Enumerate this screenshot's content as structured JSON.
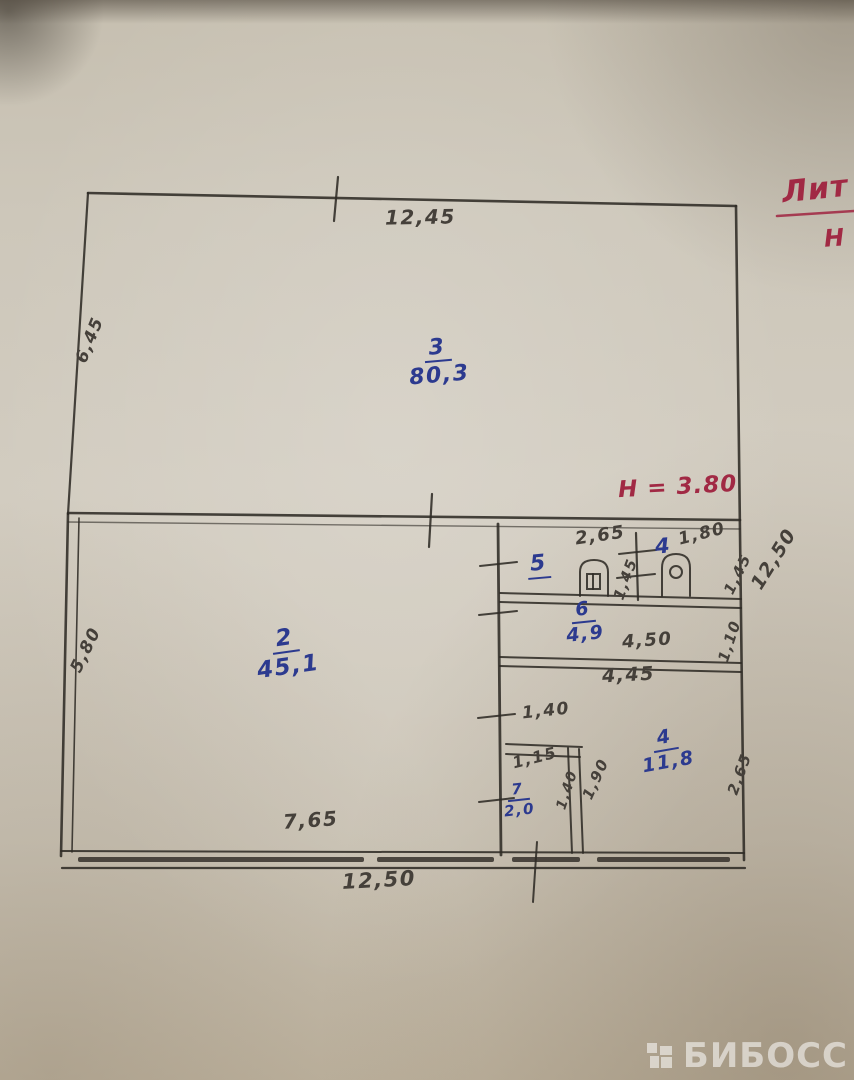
{
  "document": {
    "type": "hand-drawn floor plan (technical passport sketch)"
  },
  "red_notes": {
    "litera": "Лит",
    "litera_sub": "Н",
    "height_note": "Н = 3.80"
  },
  "rooms": {
    "r3": {
      "num": "3",
      "area": "80,3"
    },
    "r2": {
      "num": "2",
      "area": "45,1"
    },
    "r5": {
      "num": "5"
    },
    "r4s": {
      "num": "4"
    },
    "r6": {
      "num": "6",
      "area": "4,9"
    },
    "r7": {
      "num": "7",
      "area": "2,0"
    },
    "r4": {
      "num": "4",
      "area": "11,8"
    }
  },
  "dims": {
    "top": "12,45",
    "left_upper": "6,45",
    "left_lower": "5,80",
    "right_upper": "12,50",
    "room5_w": "2,65",
    "room5_h": "1,45",
    "room4s_w": "1,80",
    "room4s_h": "1,45",
    "room6_w": "4,50",
    "room6_h": "1,10",
    "room6_outer": "4,45",
    "closet_top": "1,40",
    "closet_inner_w": "1,15",
    "closet_inner_h": "1,40",
    "closet_h": "1,90",
    "room4_h": "2,65",
    "bottom_inner": "7,65",
    "bottom_outer": "12,50"
  },
  "colors": {
    "pencil": "#45403a",
    "blue_ink": "#2c3a8f",
    "red_ink": "#a12944",
    "paper": "#cbc4b5"
  },
  "watermark": {
    "text": "БИБОСС"
  }
}
